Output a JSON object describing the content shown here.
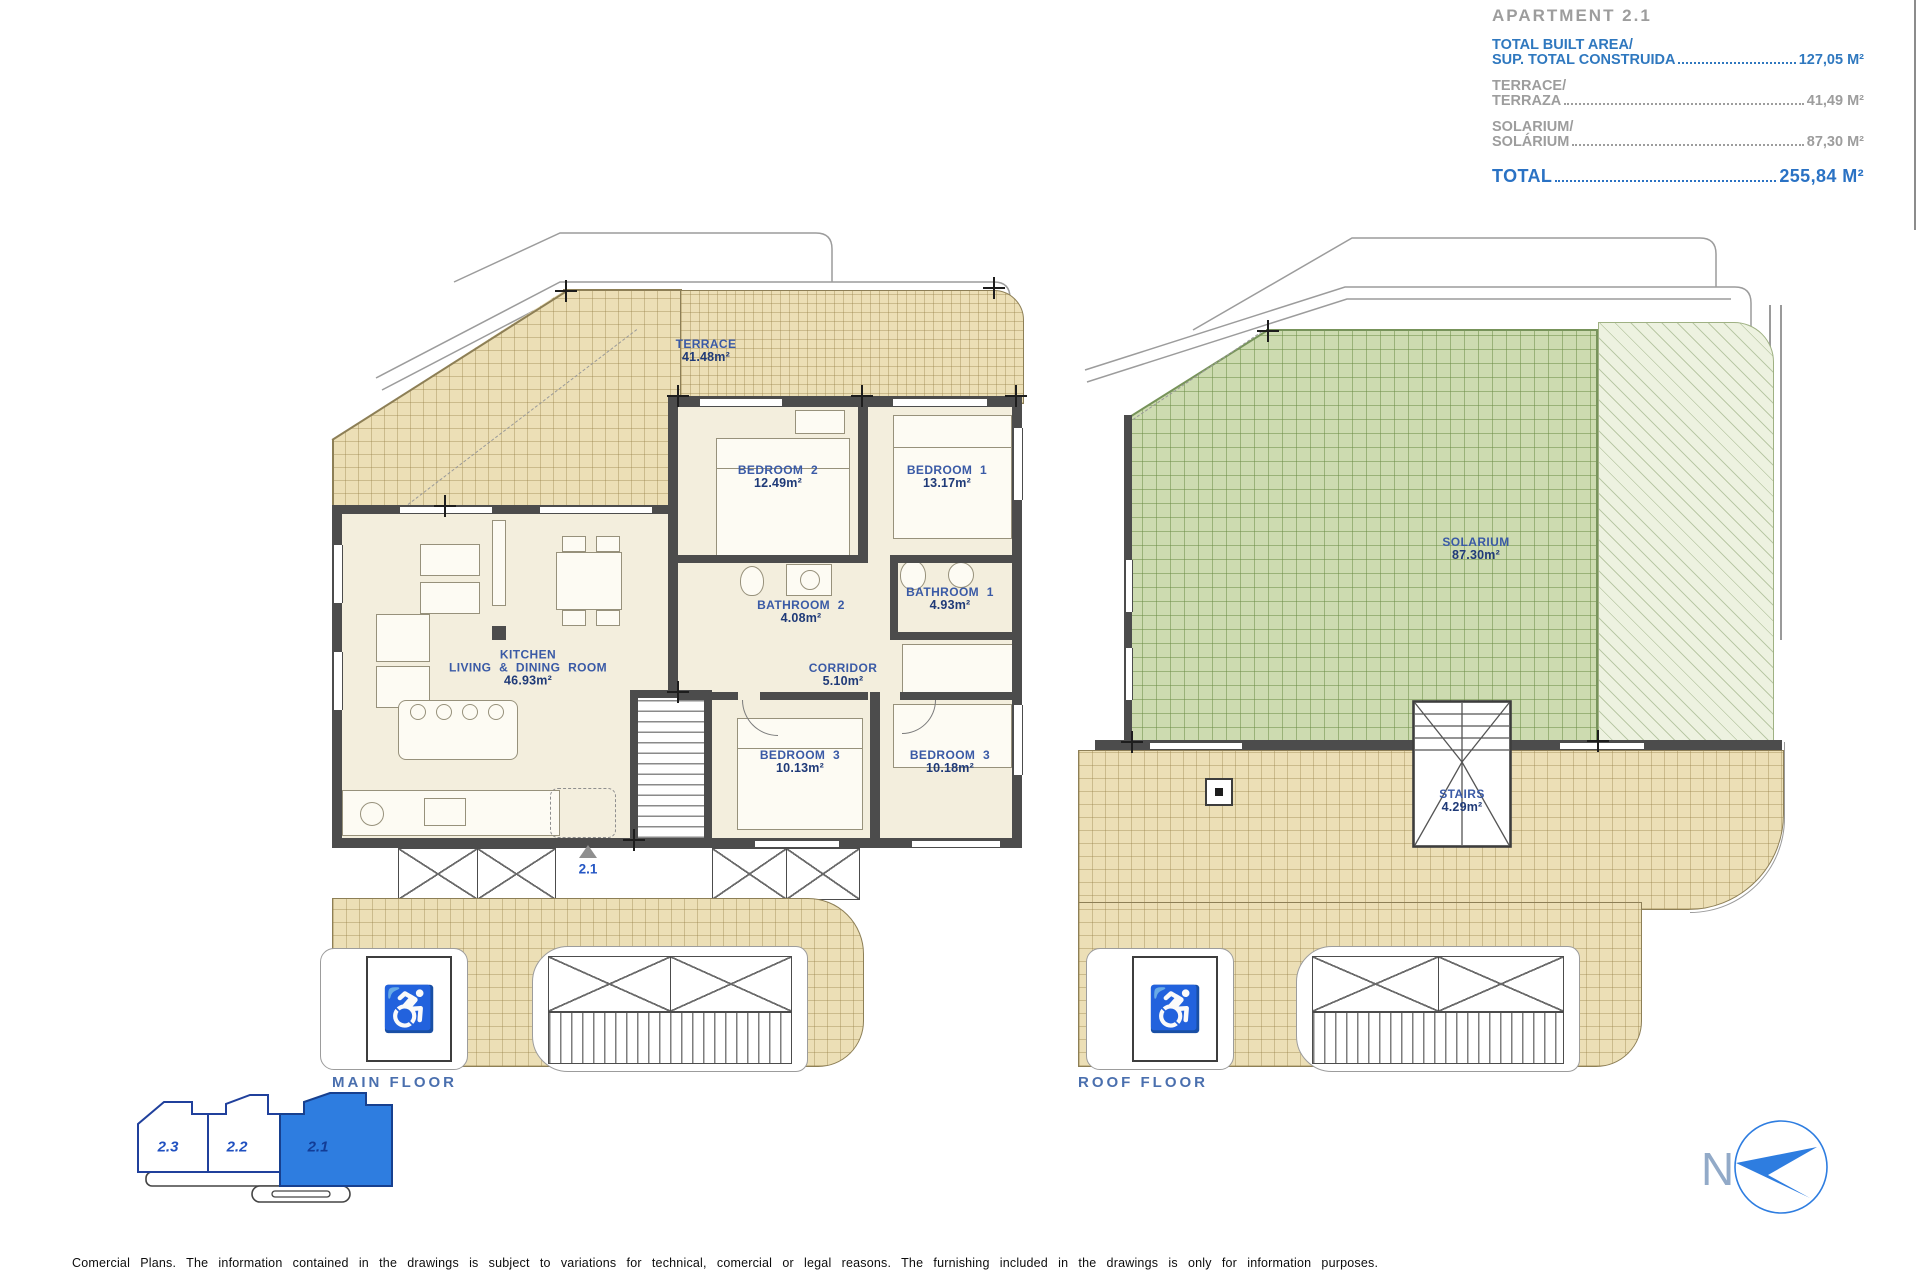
{
  "header": {
    "title": "APARTMENT 2.1",
    "items": [
      {
        "line1": "TOTAL BUILT AREA/",
        "line2": "SUP. TOTAL CONSTRUIDA",
        "value": "127,05 M²"
      },
      {
        "line1": "TERRACE/",
        "line2": "TERRAZA",
        "value": "41,49 M²"
      },
      {
        "line1": "SOLARIUM/",
        "line2": "SOLÁRIUM",
        "value": "87,30 M²"
      }
    ],
    "total_label": "TOTAL",
    "total_value": "255,84 M²"
  },
  "main_floor": {
    "caption": "MAIN FLOOR",
    "entry_unit": "2.1",
    "terrace": {
      "name": "TERRACE",
      "area": "41.48m²"
    },
    "bedroom2": {
      "name": "BEDROOM 2",
      "area": "12.49m²"
    },
    "bedroom1": {
      "name": "BEDROOM 1",
      "area": "13.17m²"
    },
    "bathroom2": {
      "name": "BATHROOM 2",
      "area": "4.08m²"
    },
    "bathroom1": {
      "name": "BATHROOM 1",
      "area": "4.93m²"
    },
    "corridor": {
      "name": "CORRIDOR",
      "area": "5.10m²"
    },
    "kitchen": {
      "name1": "KITCHEN",
      "name2": "LIVING & DINING ROOM",
      "area": "46.93m²"
    },
    "bedroom3a": {
      "name": "BEDROOM 3",
      "area": "10.13m²"
    },
    "bedroom3b": {
      "name": "BEDROOM 3",
      "area": "10.18m²"
    }
  },
  "roof_floor": {
    "caption": "ROOF FLOOR",
    "solarium": {
      "name": "SOLARIUM",
      "area": "87.30m²"
    },
    "stairs": {
      "name": "STAIRS",
      "area": "4.29m²"
    }
  },
  "key_plan": {
    "unit1": "2.3",
    "unit2": "2.2",
    "unit3": "2.1"
  },
  "compass": {
    "north": "N"
  },
  "footer": {
    "disclaimer": "Comercial Plans. The information contained in the drawings is subject to variations for technical, comercial or legal reasons. The furnishing included in the drawings is only for information purposes."
  },
  "colors": {
    "accent_blue": "#2e7de0",
    "label_blue": "#3a5aa6",
    "header_blue": "#2f78bf",
    "header_gray": "#9d9d9d",
    "tan": "#ecdfb6",
    "green": "#cddbb0",
    "wall": "#4c4c4c"
  }
}
